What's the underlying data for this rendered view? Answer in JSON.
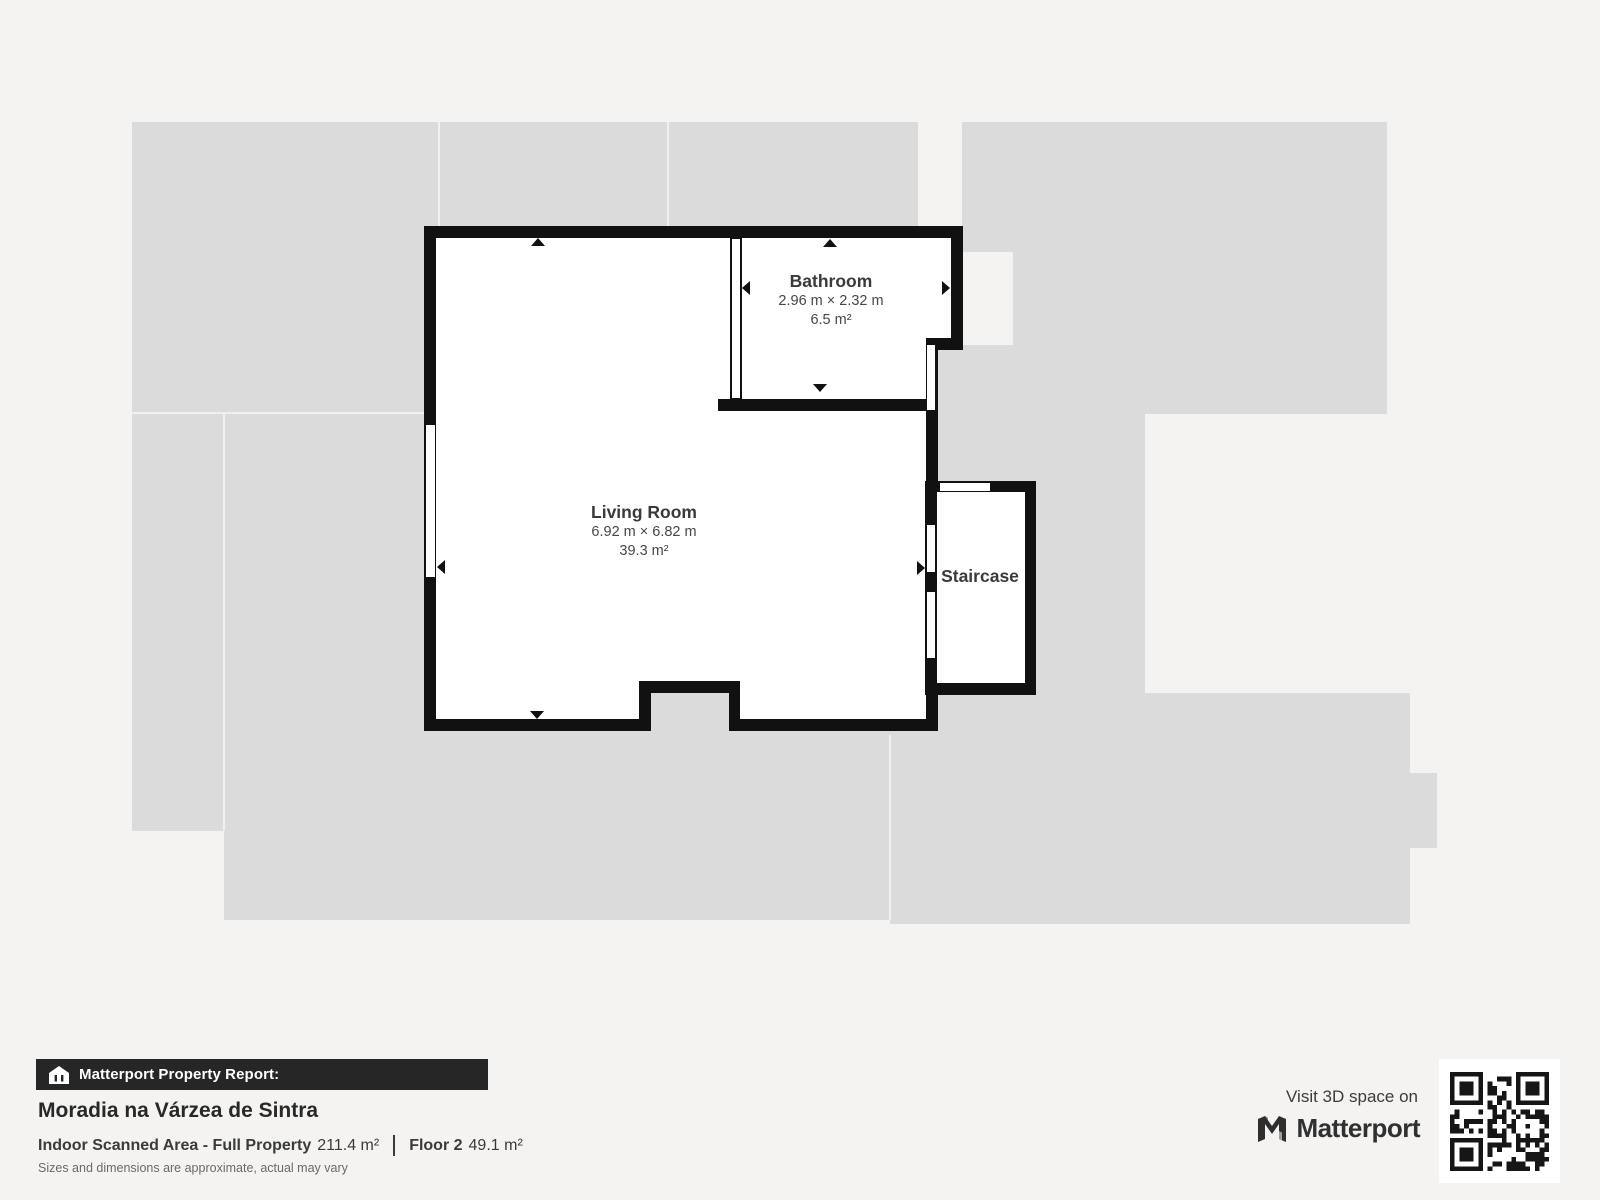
{
  "floorplan": {
    "rooms": [
      {
        "name": "Living Room",
        "dims": "6.92 m × 6.82 m",
        "area": "39.3 m²"
      },
      {
        "name": "Bathroom",
        "dims": "2.96 m × 2.32 m",
        "area": "6.5 m²"
      },
      {
        "name": "Staircase"
      }
    ]
  },
  "footer": {
    "report_label": "Matterport Property Report:",
    "property_name": "Moradia na Várzea de Sintra",
    "scanned_area_label": "Indoor Scanned Area - Full Property",
    "scanned_area_value": "211.4 m²",
    "floor_label": "Floor 2",
    "floor_value": "49.1 m²",
    "disclaimer": "Sizes and dimensions are approximate, actual may vary",
    "visit_label": "Visit 3D space on",
    "brand": "Matterport"
  },
  "icons": {
    "house_icon": "scanned-property-house",
    "brand_icon": "matterport-m-logo",
    "qr_code": "qr-code"
  },
  "colors": {
    "background": "#f4f3f1",
    "underlay_gray": "#dbdbdb",
    "wall_black": "#111111",
    "footer_bar": "#262626",
    "label_text": "#3a3a3a"
  }
}
